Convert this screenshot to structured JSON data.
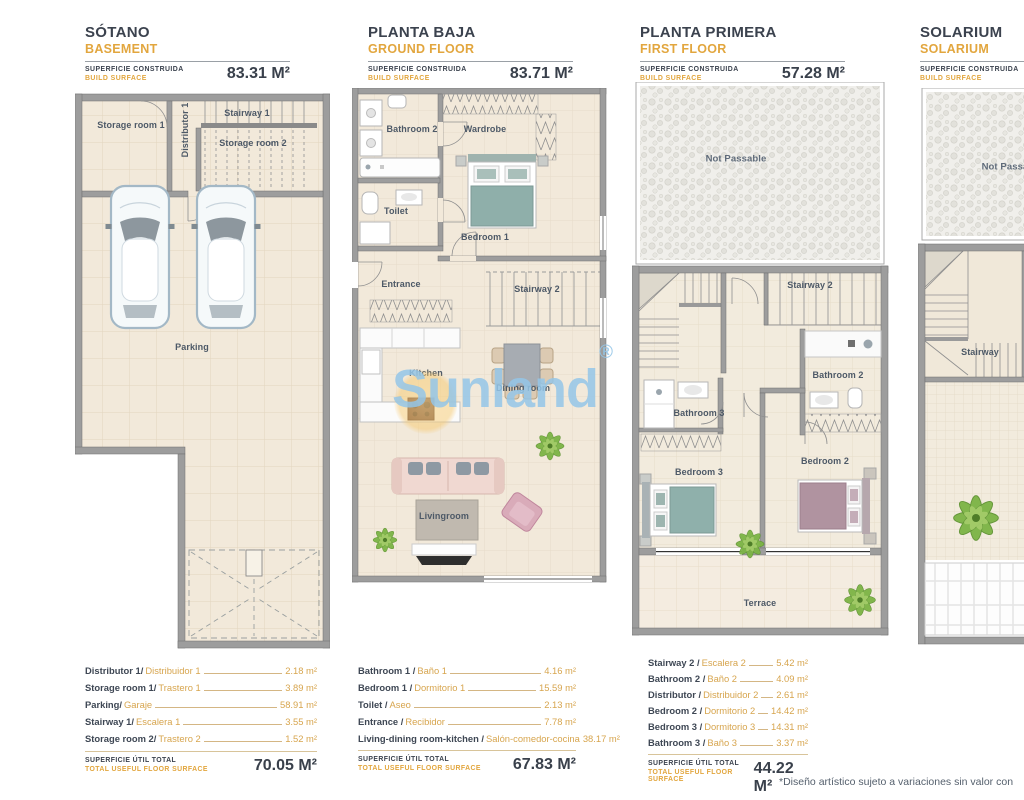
{
  "colors": {
    "accent_orange": "#e2a63e",
    "ink": "#3b424e",
    "watermark_blue": "#94c5e7",
    "watermark_sun": "#f6c86e",
    "wall_gray": "#9d9d9d",
    "floor_cream": "#f2e9da"
  },
  "watermark": {
    "text": "Sunland",
    "reg": "®"
  },
  "footnote": "*Diseño artístico sujeto a variaciones sin valor con",
  "shared": {
    "build_label_es": "SUPERFICIE CONSTRUIDA",
    "build_label_en": "BUILD SURFACE",
    "total_label_es": "SUPERFICIE ÚTIL TOTAL",
    "total_label_en": "TOTAL USEFUL FLOOR SURFACE"
  },
  "panels": [
    {
      "title_es": "SÓTANO",
      "title_en": "BASEMENT",
      "build_value": "83.31 M²",
      "rooms": {
        "storage1": "Storage room 1",
        "distributor": "Distributor 1",
        "stairway1": "Stairway 1",
        "storage2": "Storage room 2",
        "parking": "Parking"
      },
      "legend": [
        {
          "en": "Distributor 1/",
          "es": "Distribuidor 1",
          "value": "2.18 m²"
        },
        {
          "en": "Storage room 1/",
          "es": "Trastero 1",
          "value": "3.89 m²"
        },
        {
          "en": "Parking/",
          "es": "Garaje",
          "value": "58.91 m²"
        },
        {
          "en": "Stairway 1/",
          "es": "Escalera 1",
          "value": "3.55 m²"
        },
        {
          "en": "Storage room 2/",
          "es": "Trastero 2",
          "value": "1.52 m²"
        }
      ],
      "total_value": "70.05 M²"
    },
    {
      "title_es": "PLANTA BAJA",
      "title_en": "GROUND FLOOR",
      "build_value": "83.71 M²",
      "rooms": {
        "bathroom2": "Bathroom 2",
        "wardrobe": "Wardrobe",
        "toilet": "Toilet",
        "bedroom1": "Bedroom 1",
        "entrance": "Entrance",
        "stairway2": "Stairway 2",
        "kitchen": "Kitchen",
        "dining": "Dining room",
        "living": "Livingroom"
      },
      "legend": [
        {
          "en": "Bathroom 1 /",
          "es": "Baño 1",
          "value": "4.16 m²"
        },
        {
          "en": "Bedroom 1 /",
          "es": "Dormitorio 1",
          "value": "15.59 m²"
        },
        {
          "en": "Toilet /",
          "es": "Aseo",
          "value": "2.13 m²"
        },
        {
          "en": "Entrance /",
          "es": "Recibidor",
          "value": "7.78 m²"
        },
        {
          "en": "Living-dining room-kitchen /",
          "es": "Salón-comedor-cocina",
          "value": "38.17 m²"
        }
      ],
      "total_value": "67.83 M²"
    },
    {
      "title_es": "PLANTA PRIMERA",
      "title_en": "FIRST FLOOR",
      "build_value": "57.28 M²",
      "rooms": {
        "not_passable": "Not Passable",
        "stairway2": "Stairway 2",
        "bathroom2": "Bathroom 2",
        "bathroom3": "Bathroom 3",
        "bedroom2": "Bedroom 2",
        "bedroom3": "Bedroom 3",
        "terrace": "Terrace"
      },
      "legend": [
        {
          "en": "Stairway 2 /",
          "es": "Escalera 2",
          "value": "5.42 m²"
        },
        {
          "en": "Bathroom 2 /",
          "es": "Baño 2",
          "value": "4.09 m²"
        },
        {
          "en": "Distributor /",
          "es": "Distribuidor 2",
          "value": "2.61 m²"
        },
        {
          "en": "Bedroom 2 /",
          "es": "Dormitorio 2",
          "value": "14.42 m²"
        },
        {
          "en": "Bedroom 3 /",
          "es": "Dormitorio 3",
          "value": "14.31 m²"
        },
        {
          "en": "Bathroom 3 /",
          "es": "Baño 3",
          "value": "3.37 m²"
        }
      ],
      "total_value": "44.22 M²"
    },
    {
      "title_es": "SOLARIUM",
      "title_en": "SOLARIUM",
      "rooms": {
        "not_passable": "Not Passable",
        "stairway": "Stairway"
      }
    }
  ]
}
